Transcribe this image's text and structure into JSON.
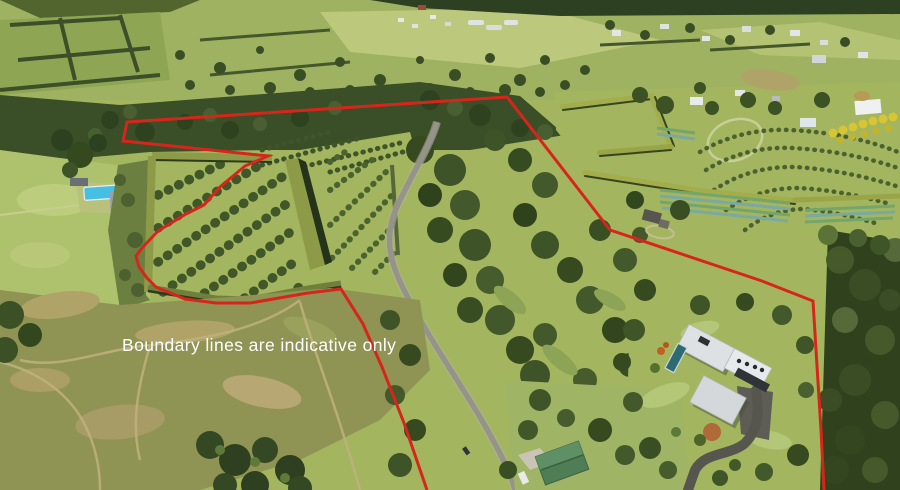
{
  "image": {
    "kind": "aerial-property-photo",
    "width": 900,
    "height": 490
  },
  "overlay": {
    "disclaimer": "Boundary lines are indicative only",
    "boundary_points": "427,490 404,423 382,367 363,324 341,289 308,293 250,303 216,303 185,299 156,287 147,278 139,267 136,256 142,248 158,231 186,214 204,205 220,187 245,166 268,156 123,141 127,122 507,97 610,230 762,281 813,301 818,382 821,430 824,490"
  },
  "palette": {
    "boundary": "#d8251c",
    "text": "#ffffff",
    "grass": "#a3b65f",
    "grass_light": "#aec26d",
    "grass_pale": "#bcc97d",
    "bush": "#3c5127",
    "forest": "#3a4e28",
    "hedge": "#8d9a47",
    "hedge_olive": "#a3ad4b",
    "hedge_shadow": "#2c3b1e",
    "road": "#96948a",
    "driveway": "#56564f",
    "roof": "#dde1e4",
    "pool_blue": "#45bfe3",
    "pool_teal": "#2d6b72",
    "shed_green": "#4e7d56",
    "scrub": "#8f9454",
    "dirt": "#b0a368",
    "flower_yellow": "#d8c531"
  },
  "scene": {
    "features": [
      "orchard-blocks-with-shelter-hedges",
      "left-house-with-swimming-pool",
      "country-road",
      "native-bush-gully",
      "terraced-orchard-right",
      "vegetable-rows",
      "yellow-flowering-trees",
      "cottage",
      "main-house-with-pool-and-driveway",
      "green-roof-shed",
      "rough-hill-paddock"
    ]
  }
}
